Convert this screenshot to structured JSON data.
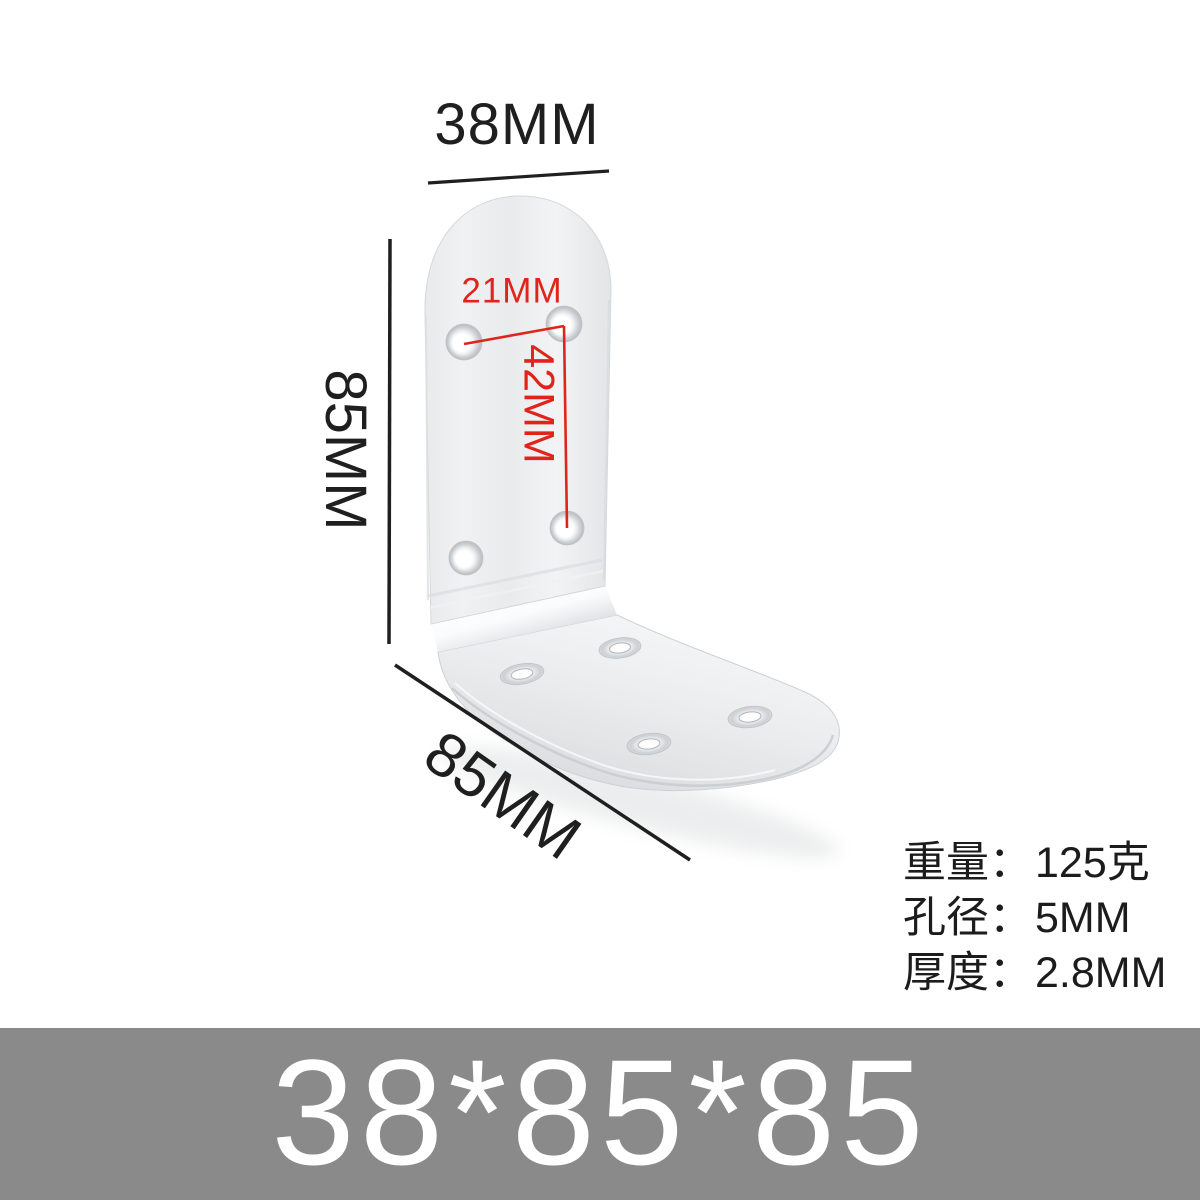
{
  "page": {
    "background_color": "#ffffff",
    "description": "Product image of an L-shaped stainless steel corner bracket with dimension annotations"
  },
  "annotations": {
    "dimension_color": "#1f1f1f",
    "highlight_color": "#e0241b",
    "top_width": "38MM",
    "left_height": "85MM",
    "bottom_depth": "85MM",
    "hole_pitch_horizontal": "21MM",
    "hole_pitch_vertical": "42MM"
  },
  "specs": {
    "rows": [
      {
        "label": "重量：",
        "value": "125克"
      },
      {
        "label": "孔径：",
        "value": "5MM"
      },
      {
        "label": "厚度：",
        "value": "2.8MM"
      }
    ]
  },
  "banner": {
    "text": "38*85*85",
    "bg_color": "#8a8a8a",
    "text_color": "#ffffff"
  },
  "product": {
    "type": "L-shaped corner bracket, brushed stainless steel",
    "hole_count_vertical_plate": 4,
    "hole_count_base_plate": 4
  }
}
